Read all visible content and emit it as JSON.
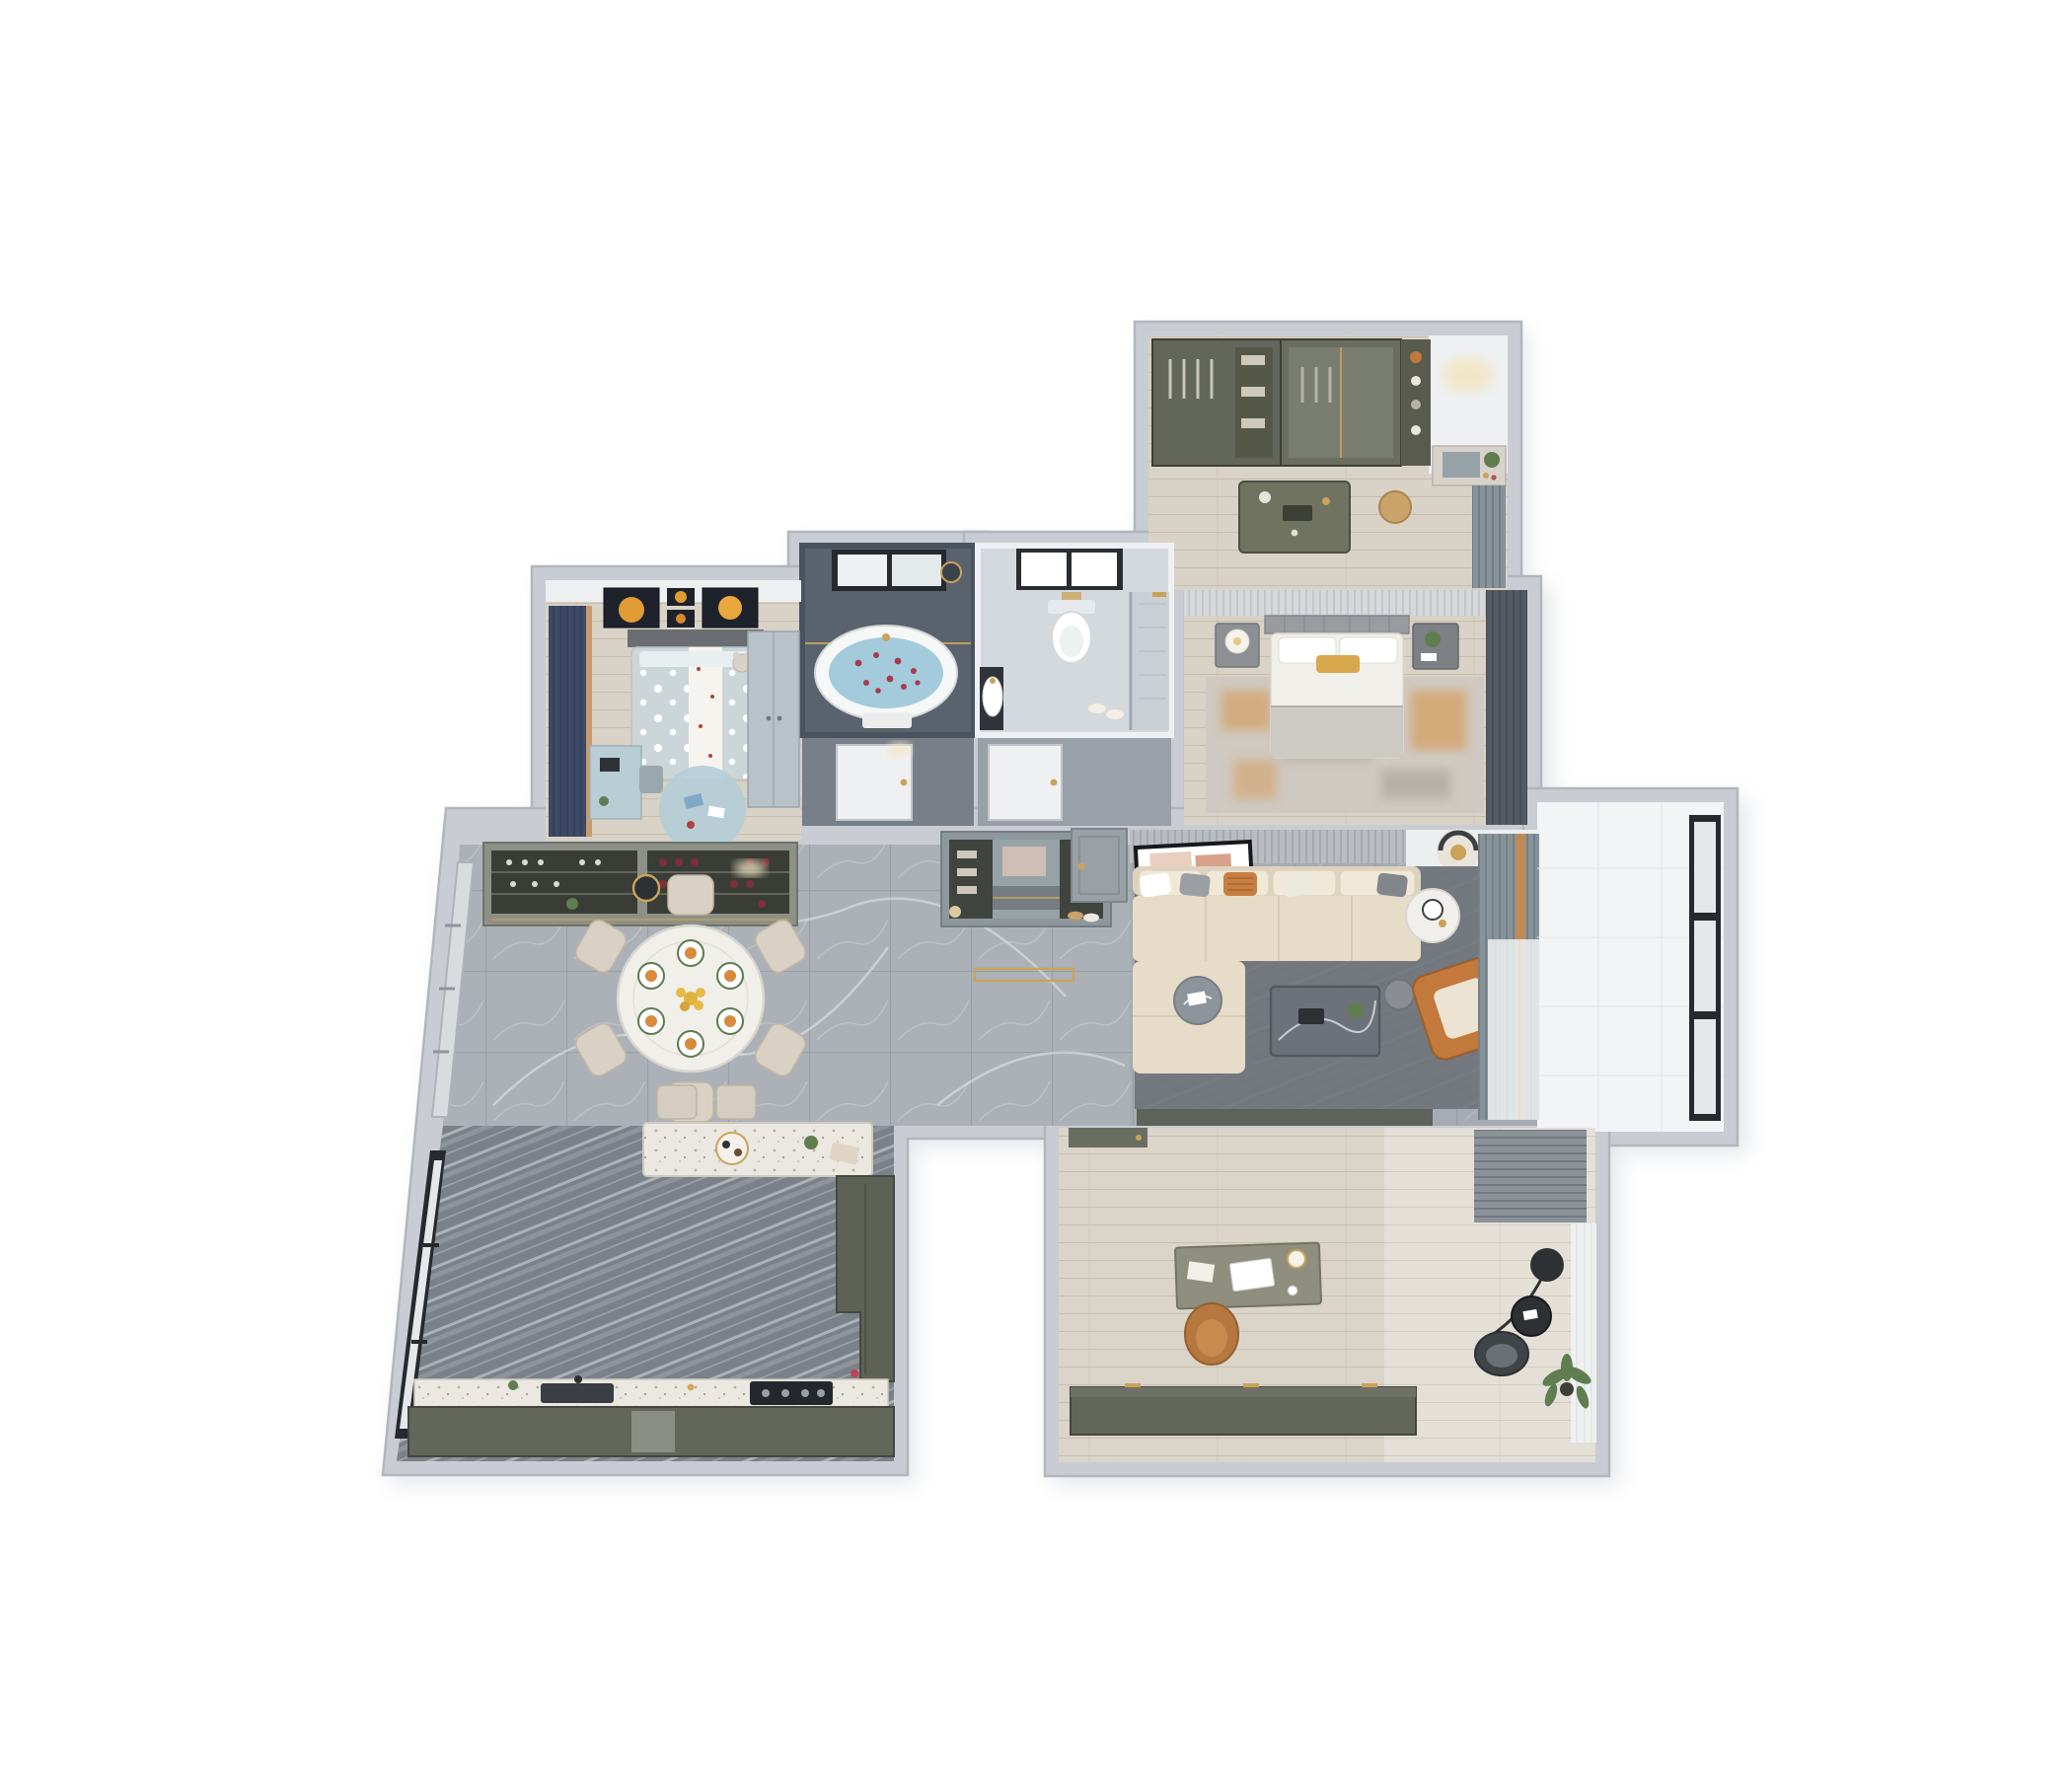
{
  "scene": {
    "type": "3d-apartment-floor-plan-render",
    "view": "top-down dollhouse cutaway",
    "background": "#ffffff"
  },
  "palette": {
    "bg": "#ffffff",
    "wall": "#c9ccd2",
    "wallEdge": "#b2b6bd",
    "shadow": "#e0e3e7",
    "marble": "#acb1b8",
    "marbleLine": "#9aa0a7",
    "marbleVein": "#ebedf0",
    "livingTint": "#979da5",
    "kitchenFloor": "#7b8189",
    "kitchenStreak": "#d5dade",
    "woodA": "#d9d2c6",
    "woodLine": "#c6beaf",
    "woodPale": "#e4e0d8",
    "slateFloor": "#5a626d",
    "slateWall": "#4a525d",
    "nicheDark": "#787f88",
    "nicheLight": "#9aa0a7",
    "bathLight": "#d4d9de",
    "bathWhite": "#eef0f3",
    "terrazzo": "#eae8e1",
    "terrazzoDot": "#b5afa3",
    "olive": "#63665a",
    "oliveDark": "#3c3f36",
    "oliveLight": "#8d9086",
    "navyCurtain": "#3d4a66",
    "kidsBed": "#ccd6d9",
    "kidsRug": "#b6cdd8",
    "kidsDesk": "#b9cdd4",
    "sofa": "#e6dcc8",
    "cushion": "#f0e9d8",
    "rugLiving": "#72767d",
    "rugMaster": "#cfc9c1",
    "orange": "#c2793b",
    "orangeSoft": "#d78f3e",
    "yellow": "#e2b23f",
    "gold": "#c9a45a",
    "curtainGray": "#87939a",
    "curtainDark": "#535a64",
    "sheer": "#f0f2f3",
    "water": "#a4cbdc",
    "petal": "#a83a50",
    "frameBlack": "#26292d",
    "glass": "#e4e8ea",
    "whiteSoft": "#f4f3f0",
    "tanBasket": "#c9a36a",
    "chairTan": "#b5793f",
    "tableMarble": "#6d727a",
    "mirror": "#97a2a7",
    "plant": "#5f7d4f"
  },
  "rooms": [
    {
      "id": "walk-in-closet",
      "label": "walk-in closet",
      "furniture": [
        "wardrobe-open-shelving",
        "glass-wardrobe",
        "island-dresser",
        "vanity-with-mirror",
        "rattan-basket",
        "window-curtain"
      ]
    },
    {
      "id": "master-bedroom",
      "label": "master bedroom",
      "furniture": [
        "double-bed",
        "headboard",
        "nightstand-left",
        "table-lamp",
        "nightstand-right",
        "plant",
        "distressed-rug",
        "blackout-curtains"
      ]
    },
    {
      "id": "master-bathroom",
      "label": "master bathroom",
      "furniture": [
        "freestanding-bathtub",
        "rose-petal-water",
        "black-frame-window",
        "brass-fixtures",
        "towel"
      ]
    },
    {
      "id": "guest-bathroom",
      "label": "guest bathroom",
      "furniture": [
        "wall-hung-toilet",
        "wash-basin",
        "glass-shower",
        "window",
        "slippers"
      ]
    },
    {
      "id": "kids-bedroom",
      "label": "kids bedroom",
      "furniture": [
        "polka-dot-bed",
        "teddy-bear",
        "planet-wall-art",
        "study-desk",
        "round-play-rug",
        "wardrobe",
        "navy-curtains"
      ]
    },
    {
      "id": "dining-room",
      "label": "dining room",
      "furniture": [
        "round-dining-table",
        "dining-chairs-x6",
        "wine-display-cabinet",
        "pendant-light",
        "window-wall"
      ]
    },
    {
      "id": "kitchen",
      "label": "open kitchen",
      "furniture": [
        "terrazzo-island",
        "bar-stools-x2",
        "sink",
        "cooktop",
        "base-cabinets",
        "tall-cabinet",
        "window-wall"
      ]
    },
    {
      "id": "foyer",
      "label": "entry foyer",
      "furniture": [
        "shoe-cabinet-with-mirror",
        "entrance-door",
        "gold-doormat"
      ]
    },
    {
      "id": "living-room",
      "label": "living room",
      "furniture": [
        "sectional-sofa",
        "throw-pillows",
        "marble-coffee-table",
        "round-side-table",
        "table-lamp",
        "orange-armchair",
        "leaning-art-frame",
        "ceiling-light",
        "gray-rug",
        "layered-curtains"
      ]
    },
    {
      "id": "balcony",
      "label": "balcony",
      "furniture": [
        "floor-to-ceiling-window"
      ]
    },
    {
      "id": "study",
      "label": "study",
      "furniture": [
        "writing-desk",
        "laptop",
        "desk-lamp",
        "leather-office-chair",
        "low-bookshelf-cabinet",
        "arc-floor-lamp",
        "lounge-chair",
        "round-side-table",
        "potted-plant",
        "roman-blind",
        "sheer-curtain"
      ]
    }
  ],
  "doors": [
    "kids-hall-door",
    "bathroom-hall-door",
    "entrance-door",
    "study-door"
  ]
}
